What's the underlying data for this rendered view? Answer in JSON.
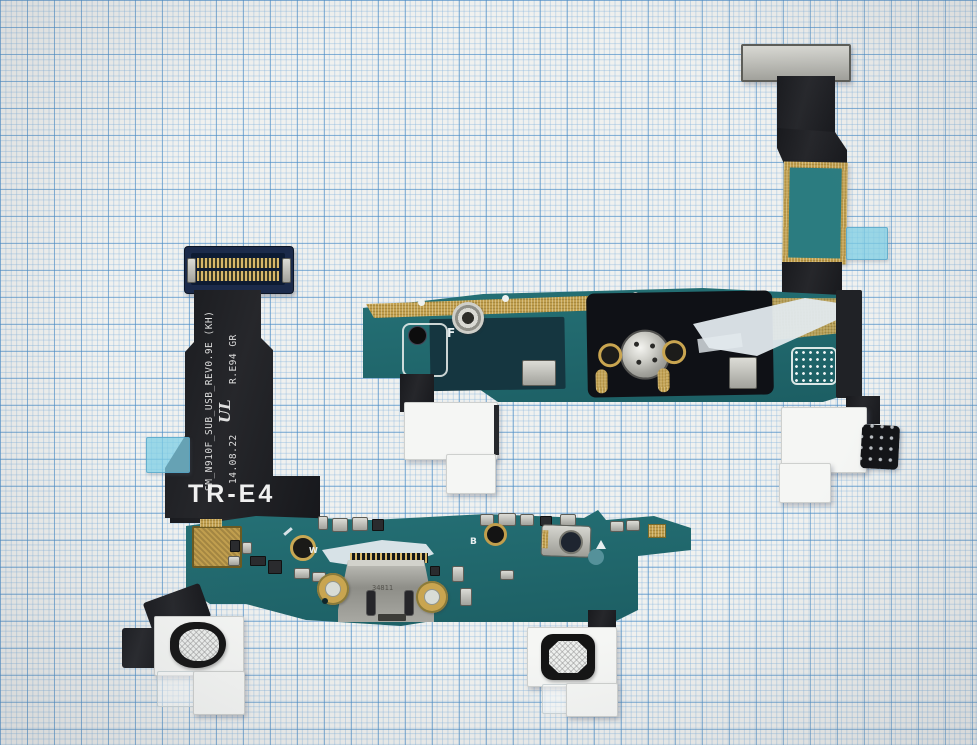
{
  "markings": {
    "flex_model_marking": "SM_N910F_SUB_USB_REV0.9E (KH)",
    "flex_date_marking": "14.08.22",
    "cert_logo_text": "UL",
    "cert_marking": "R.E94 GR",
    "flex_code": "TR-E4",
    "upper_board_letter": "F",
    "lower_board_letter_w": "W",
    "lower_board_letter_b": "B",
    "usb_shell_etch": "34811"
  },
  "colors": {
    "paper": "#f0f1ef",
    "grid_minor": "#aecde8",
    "grid_major": "#5f9cc9",
    "pcb_teal": "#216a6f",
    "gold": "#c09e4e",
    "flex_black": "#17181c",
    "pad_white": "#f5f6f4",
    "tab_cyan": "#7dcde4",
    "metal_silver": "#b9b9b3"
  }
}
